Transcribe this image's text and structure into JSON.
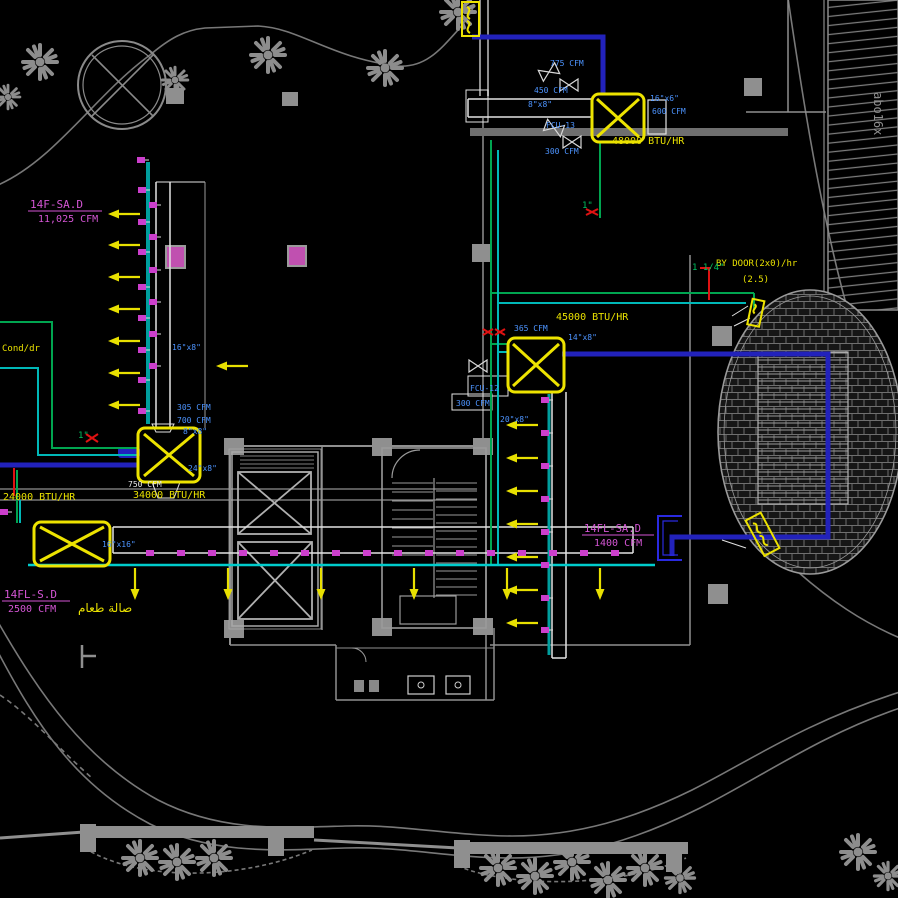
{
  "colors": {
    "background": "#000000",
    "wall_gray": "#8f8f8f",
    "outline_gray": "#787878",
    "duct_white": "#e2e2e2",
    "pipe_navy": "#2222bb",
    "pipe_green": "#00a550",
    "pipe_cyan": "#00b8b8",
    "equipment_yellow": "#ede300",
    "diffuser_magenta": "#cc3fcc",
    "label_blue": "#4d94ff",
    "marker_red": "#e01212",
    "label_magenta": "#d455d4",
    "label_yellow": "#e8e000",
    "label_white": "#e8e8e8"
  },
  "t": {
    "zone1a": "14F-SA.D",
    "zone1b": "11,025 CFM",
    "zone2a": "14FL-S.D",
    "zone2b": "2500 CFM",
    "zone2c": "صالة طعام",
    "zone3a": "14FL-SA.D",
    "zone3b": "1400 CFM",
    "btu_top": "48000 BTU/HR",
    "btu_center": "45000 BTU/HR",
    "btu_left": "34000 BTU/HR",
    "btu_small": "24000 BTU/HR",
    "cfm_775": "775 CFM",
    "cfm_450": "450 CFM",
    "cfm_300a": "300 CFM",
    "size_8x8_top": "8\"x8\"",
    "tag_fcu13": "FCU-13",
    "size_16x6": "16\"x6\"",
    "cfm_600": "600 CFM",
    "cfm_365": "365 CFM",
    "size_14x8": "14\"x8\"",
    "tag_fcu12": "FCU-12",
    "cfm_300b": "300 CFM",
    "size_20x8": "20\"x8\"",
    "cfm_305": "305 CFM",
    "cfm_700": "700 CFM",
    "size_8x8_left": "8\"x8\"",
    "size_24x8": "24\"x8\"",
    "cfm_750": "750 CFM",
    "size_16x8": "16\"x8\"",
    "size_16x16": "16\"x16\"",
    "cond": "Cond/dr",
    "door1": "BY DOOR(2x0)/hr",
    "door2": "(2.5)",
    "pipe_114": "1 1/4\"",
    "pipe_1a": "1\"",
    "pipe_1b": "1\"",
    "watermark": "abo16x"
  }
}
